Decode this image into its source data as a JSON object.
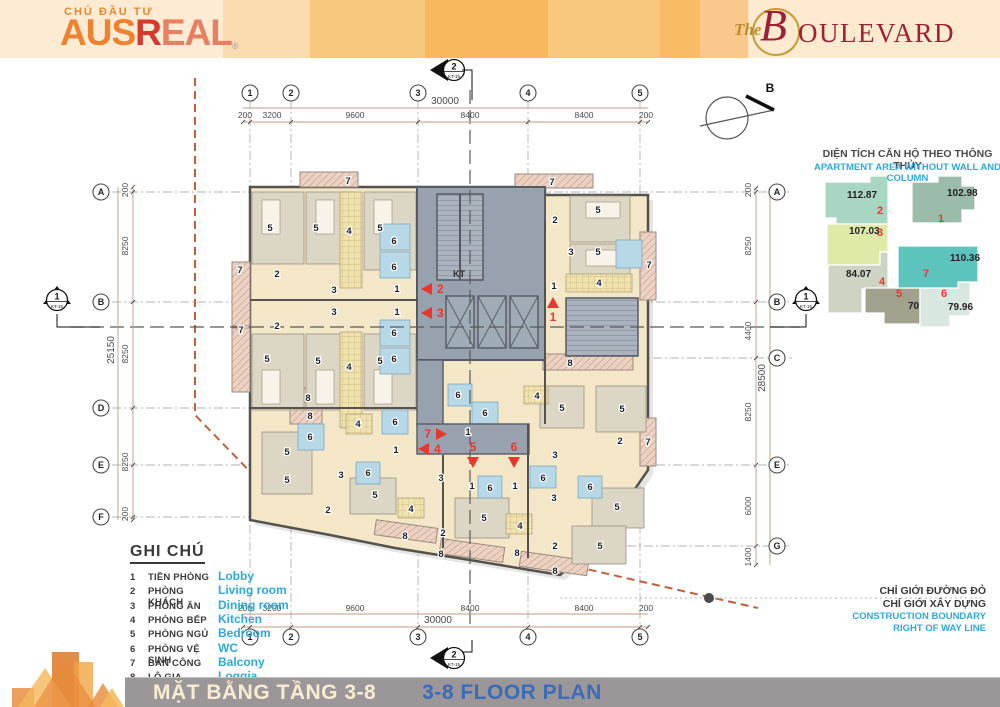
{
  "colors": {
    "red_accent": "#e8372c",
    "cyan": "#2ea9dd",
    "footer_blue": "#3a6cb8",
    "footer_cream": "#f6ecd0",
    "dim": "#4a4a4a",
    "wall": "#55524e",
    "core": "#97a2ae",
    "cream": "#f3e7c8"
  },
  "header": {
    "investor_label": "CHỦ ĐẦU TƯ",
    "brand": {
      "aus": "AUS",
      "r": "R",
      "eal": "EAL",
      "reg": "®"
    },
    "project": {
      "the": "The",
      "b": "B",
      "rest": "OULEVARD"
    }
  },
  "key_plan": {
    "title_vi": "DIỆN TÍCH CĂN HỘ THEO THÔNG THỦY",
    "title_en": "APARTMENT AREA WITHOUT WALL AND COLUMN",
    "units": [
      {
        "id": "1",
        "area": "102.98",
        "color": "#9bbcaa",
        "ax": 947,
        "ay": 196,
        "ix": 941,
        "iy": 222
      },
      {
        "id": "2",
        "area": "112.87",
        "color": "#a9d6c2",
        "ax": 847,
        "ay": 198,
        "ix": 880,
        "iy": 214
      },
      {
        "id": "3",
        "area": "107.03",
        "color": "#dfe9a8",
        "ax": 849,
        "ay": 234,
        "ix": 880,
        "iy": 236
      },
      {
        "id": "4",
        "area": "84.07",
        "color": "#ced4c4",
        "ax": 846,
        "ay": 277,
        "ix": 882,
        "iy": 285
      },
      {
        "id": "5",
        "area": "70.57",
        "color": "#a2a18d",
        "ax": 908,
        "ay": 309,
        "ix": 899,
        "iy": 297
      },
      {
        "id": "6",
        "area": "79.96",
        "color": "#d8e8e1",
        "ax": 948,
        "ay": 310,
        "ix": 944,
        "iy": 297
      },
      {
        "id": "7",
        "area": "110.36",
        "color": "#5cc3bd",
        "ax": 950,
        "ay": 261,
        "ix": 926,
        "iy": 277
      }
    ]
  },
  "legend": {
    "title": "GHI CHÚ",
    "items": [
      {
        "no": "1",
        "vi": "TIỀN PHÒNG",
        "en": "Lobby"
      },
      {
        "no": "2",
        "vi": "PHÒNG KHÁCH",
        "en": "Living room"
      },
      {
        "no": "3",
        "vi": "PHÒNG ĂN",
        "en": "Dining room"
      },
      {
        "no": "4",
        "vi": "PHÒNG BẾP",
        "en": "Kitchen"
      },
      {
        "no": "5",
        "vi": "PHÒNG NGỦ",
        "en": "Bedroom"
      },
      {
        "no": "6",
        "vi": "PHÒNG VỆ SINH",
        "en": "WC"
      },
      {
        "no": "7",
        "vi": "BAN CÔNG",
        "en": "Balcony"
      },
      {
        "no": "8",
        "vi": "LÔ GIA",
        "en": "Loggia"
      }
    ]
  },
  "boundary_note": {
    "vi1": "CHỈ GIỚI ĐƯỜNG ĐỎ",
    "vi2": "CHỈ GIỚI XÂY DỰNG",
    "en1": "CONSTRUCTION BOUNDARY",
    "en2": "RIGHT OF WAY LINE"
  },
  "footer": {
    "title_vi": "MẶT BẰNG TẦNG 3-8",
    "title_en": "3-8 FLOOR PLAN"
  },
  "plan": {
    "compass_label": "B",
    "kt_label": "KT",
    "grid": {
      "cols": [
        {
          "id": "1",
          "x": 250
        },
        {
          "id": "2",
          "x": 291
        },
        {
          "id": "3",
          "x": 418
        },
        {
          "id": "4",
          "x": 528
        },
        {
          "id": "5",
          "x": 640
        }
      ],
      "rows": [
        {
          "id": "A",
          "y": 192,
          "x1": 112,
          "x2": 792,
          "bL": 1,
          "bR": 1
        },
        {
          "id": "B",
          "y": 302,
          "x1": 112,
          "x2": 792,
          "bL": 1,
          "bR": 1
        },
        {
          "id": "C",
          "y": 358,
          "x1": 500,
          "x2": 792,
          "bL": 0,
          "bR": 1
        },
        {
          "id": "D",
          "y": 408,
          "x1": 112,
          "x2": 440,
          "bL": 1,
          "bR": 0
        },
        {
          "id": "E",
          "y": 465,
          "x1": 112,
          "x2": 792,
          "bL": 1,
          "bR": 1
        },
        {
          "id": "F",
          "y": 517,
          "x1": 112,
          "x2": 430,
          "bL": 1,
          "bR": 0
        },
        {
          "id": "G",
          "y": 546,
          "x1": 440,
          "x2": 792,
          "bL": 0,
          "bR": 1
        }
      ]
    },
    "dims_top": {
      "total": "30000",
      "tx": 445,
      "ty": 104,
      "segs": [
        {
          "t": "200",
          "x": 245
        },
        {
          "t": "3200",
          "x": 272
        },
        {
          "t": "9600",
          "x": 355
        },
        {
          "t": "8400",
          "x": 470
        },
        {
          "t": "8400",
          "x": 584
        },
        {
          "t": "200",
          "x": 646
        }
      ]
    },
    "dims_bottom": {
      "total": "30000",
      "tx": 438,
      "ty": 623,
      "segs": [
        {
          "t": "200",
          "x": 245
        },
        {
          "t": "3200",
          "x": 272
        },
        {
          "t": "9600",
          "x": 355
        },
        {
          "t": "8400",
          "x": 470
        },
        {
          "t": "8400",
          "x": 584
        },
        {
          "t": "200",
          "x": 646
        }
      ]
    },
    "dims_left": {
      "total": "25150",
      "tx": 114,
      "ty": 350,
      "segs": [
        {
          "t": "200",
          "y": 190
        },
        {
          "t": "8250",
          "y": 246
        },
        {
          "t": "8250",
          "y": 354
        },
        {
          "t": "8250",
          "y": 462
        },
        {
          "t": "200",
          "y": 514
        }
      ]
    },
    "dims_right": {
      "total": "28500",
      "tx": 765,
      "ty": 378,
      "segs": [
        {
          "t": "200",
          "y": 190
        },
        {
          "t": "8250",
          "y": 246
        },
        {
          "t": "4400",
          "y": 331
        },
        {
          "t": "8250",
          "y": 412
        },
        {
          "t": "6000",
          "y": 506
        },
        {
          "t": "1400",
          "y": 557
        }
      ]
    },
    "section_markers": [
      {
        "label": "1",
        "sub": "KT-15",
        "x": 57,
        "y": 300,
        "dir": "up"
      },
      {
        "label": "1",
        "sub": "KT-15",
        "x": 806,
        "y": 300,
        "dir": "up"
      },
      {
        "label": "2",
        "sub": "KT-15",
        "x": 450,
        "y": 70,
        "dir": "left"
      },
      {
        "label": "2",
        "sub": "KT-15",
        "x": 450,
        "y": 658,
        "dir": "left"
      }
    ],
    "entry_arrows": [
      {
        "n": "2",
        "x": 428,
        "y": 289,
        "dir": "left"
      },
      {
        "n": "3",
        "x": 428,
        "y": 313,
        "dir": "left"
      },
      {
        "n": "1",
        "x": 553,
        "y": 304,
        "dir": "up"
      },
      {
        "n": "7",
        "x": 440,
        "y": 434,
        "dir": "right"
      },
      {
        "n": "4",
        "x": 425,
        "y": 449,
        "dir": "left"
      },
      {
        "n": "5",
        "x": 473,
        "y": 461,
        "dir": "down"
      },
      {
        "n": "6",
        "x": 514,
        "y": 461,
        "dir": "down"
      }
    ],
    "room_labels": [
      [
        "5",
        270,
        228
      ],
      [
        "5",
        316,
        228
      ],
      [
        "4",
        349,
        231
      ],
      [
        "5",
        380,
        228
      ],
      [
        "6",
        394,
        241
      ],
      [
        "6",
        394,
        267
      ],
      [
        "7",
        348,
        181
      ],
      [
        "7",
        240,
        270
      ],
      [
        "2",
        277,
        274
      ],
      [
        "3",
        334,
        290
      ],
      [
        "1",
        397,
        289
      ],
      [
        "7",
        241,
        330
      ],
      [
        "2",
        277,
        326
      ],
      [
        "3",
        334,
        312
      ],
      [
        "1",
        397,
        312
      ],
      [
        "6",
        394,
        333
      ],
      [
        "6",
        394,
        359
      ],
      [
        "5",
        267,
        359
      ],
      [
        "5",
        318,
        361
      ],
      [
        "4",
        349,
        367
      ],
      [
        "5",
        380,
        361
      ],
      [
        "7",
        552,
        182
      ],
      [
        "2",
        555,
        220
      ],
      [
        "5",
        598,
        210
      ],
      [
        "3",
        571,
        252
      ],
      [
        "5",
        598,
        252
      ],
      [
        "7",
        649,
        265
      ],
      [
        "1",
        554,
        286
      ],
      [
        "4",
        599,
        283
      ],
      [
        "8",
        308,
        398
      ],
      [
        "8",
        310,
        416
      ],
      [
        "4",
        358,
        424
      ],
      [
        "6",
        310,
        437
      ],
      [
        "6",
        395,
        422
      ],
      [
        "1",
        396,
        450
      ],
      [
        "6",
        458,
        395
      ],
      [
        "6",
        485,
        413
      ],
      [
        "1",
        468,
        432
      ],
      [
        "4",
        537,
        396
      ],
      [
        "5",
        562,
        408
      ],
      [
        "5",
        622,
        409
      ],
      [
        "2",
        620,
        441
      ],
      [
        "3",
        555,
        455
      ],
      [
        "7",
        648,
        442
      ],
      [
        "5",
        287,
        452
      ],
      [
        "5",
        287,
        480
      ],
      [
        "3",
        341,
        475
      ],
      [
        "6",
        368,
        473
      ],
      [
        "5",
        375,
        495
      ],
      [
        "2",
        328,
        510
      ],
      [
        "4",
        411,
        509
      ],
      [
        "8",
        405,
        536
      ],
      [
        "3",
        441,
        478
      ],
      [
        "1",
        472,
        486
      ],
      [
        "6",
        490,
        488
      ],
      [
        "2",
        443,
        533
      ],
      [
        "5",
        484,
        518
      ],
      [
        "8",
        441,
        554
      ],
      [
        "1",
        515,
        486
      ],
      [
        "6",
        543,
        478
      ],
      [
        "3",
        554,
        498
      ],
      [
        "4",
        520,
        526
      ],
      [
        "6",
        590,
        487
      ],
      [
        "5",
        617,
        507
      ],
      [
        "2",
        555,
        546
      ],
      [
        "8",
        517,
        553
      ],
      [
        "5",
        600,
        546
      ],
      [
        "8",
        555,
        571
      ],
      [
        "8",
        570,
        363
      ]
    ],
    "geometry": {
      "outline": [
        [
          250,
          187
        ],
        [
          545,
          187
        ],
        [
          545,
          195
        ],
        [
          648,
          195
        ],
        [
          648,
          470
        ],
        [
          600,
          540
        ],
        [
          560,
          575
        ],
        [
          470,
          560
        ],
        [
          395,
          548
        ],
        [
          330,
          535
        ],
        [
          250,
          520
        ]
      ],
      "bedrooms": [
        [
          252,
          192,
          52,
          72
        ],
        [
          306,
          192,
          50,
          72
        ],
        [
          364,
          192,
          52,
          78
        ],
        [
          252,
          334,
          52,
          76
        ],
        [
          306,
          334,
          50,
          76
        ],
        [
          364,
          334,
          52,
          76
        ],
        [
          570,
          196,
          60,
          46
        ],
        [
          570,
          244,
          60,
          44
        ],
        [
          262,
          432,
          50,
          62
        ],
        [
          350,
          478,
          46,
          36
        ],
        [
          455,
          498,
          54,
          40
        ],
        [
          540,
          386,
          44,
          42
        ],
        [
          596,
          386,
          50,
          46
        ],
        [
          592,
          488,
          52,
          40
        ],
        [
          572,
          526,
          54,
          38
        ]
      ],
      "baths": [
        [
          380,
          224,
          30,
          26
        ],
        [
          380,
          252,
          30,
          26
        ],
        [
          380,
          320,
          30,
          26
        ],
        [
          380,
          348,
          30,
          26
        ],
        [
          616,
          240,
          26,
          28
        ],
        [
          298,
          424,
          26,
          26
        ],
        [
          382,
          410,
          26,
          24
        ],
        [
          448,
          384,
          24,
          22
        ],
        [
          472,
          402,
          26,
          22
        ],
        [
          356,
          462,
          24,
          22
        ],
        [
          478,
          476,
          24,
          22
        ],
        [
          530,
          466,
          26,
          22
        ],
        [
          578,
          476,
          24,
          22
        ]
      ],
      "kitchens": [
        [
          340,
          192,
          22,
          96
        ],
        [
          340,
          332,
          22,
          96
        ],
        [
          566,
          274,
          66,
          18
        ],
        [
          346,
          414,
          26,
          20
        ],
        [
          398,
          498,
          26,
          20
        ],
        [
          506,
          514,
          26,
          20
        ],
        [
          524,
          386,
          24,
          18
        ]
      ],
      "balconies": [
        [
          300,
          172,
          58,
          15
        ],
        [
          515,
          174,
          78,
          14
        ],
        [
          232,
          262,
          18,
          64
        ],
        [
          232,
          328,
          18,
          64
        ],
        [
          640,
          232,
          16,
          68
        ],
        [
          640,
          418,
          16,
          48
        ]
      ],
      "loggias": [
        [
          290,
          388,
          32,
          36,
          0
        ],
        [
          543,
          354,
          90,
          16,
          0
        ],
        [
          375,
          524,
          62,
          15,
          8
        ],
        [
          440,
          543,
          64,
          15,
          8
        ],
        [
          520,
          556,
          68,
          15,
          8
        ]
      ],
      "beds": [
        [
          262,
          200,
          18,
          34
        ],
        [
          316,
          200,
          18,
          34
        ],
        [
          374,
          200,
          18,
          34
        ],
        [
          262,
          370,
          18,
          34
        ],
        [
          316,
          370,
          18,
          34
        ],
        [
          374,
          370,
          18,
          34
        ],
        [
          586,
          202,
          34,
          16
        ],
        [
          586,
          250,
          34,
          16
        ]
      ],
      "core": {
        "main": [
          417,
          187,
          128,
          173
        ],
        "stair1": [
          437,
          194,
          46,
          86
        ],
        "stair2": [
          566,
          298,
          72,
          58
        ],
        "elevators": [
          [
            446,
            296,
            28,
            52
          ],
          [
            478,
            296,
            28,
            52
          ],
          [
            510,
            296,
            28,
            52
          ]
        ],
        "corridor_v": [
          417,
          360,
          26,
          66
        ],
        "corridor_h": [
          417,
          424,
          112,
          30
        ]
      },
      "walls": [
        [
          250,
          300,
          418,
          300
        ],
        [
          250,
          408,
          417,
          408
        ],
        [
          545,
          222,
          545,
          424
        ],
        [
          528,
          424,
          528,
          558
        ],
        [
          443,
          455,
          443,
          548
        ]
      ],
      "red_boundary": [
        [
          195,
          78
        ],
        [
          195,
          415
        ],
        [
          300,
          523
        ],
        [
          560,
          563
        ],
        [
          709,
          597
        ],
        [
          758,
          608
        ]
      ],
      "boundary_dot": [
        709,
        598
      ],
      "gray_line": [
        560,
        598,
        985,
        598
      ],
      "section_line_h": [
        70,
        327,
        800,
        327
      ],
      "section_line_v": [
        470,
        90,
        470,
        630
      ]
    }
  }
}
